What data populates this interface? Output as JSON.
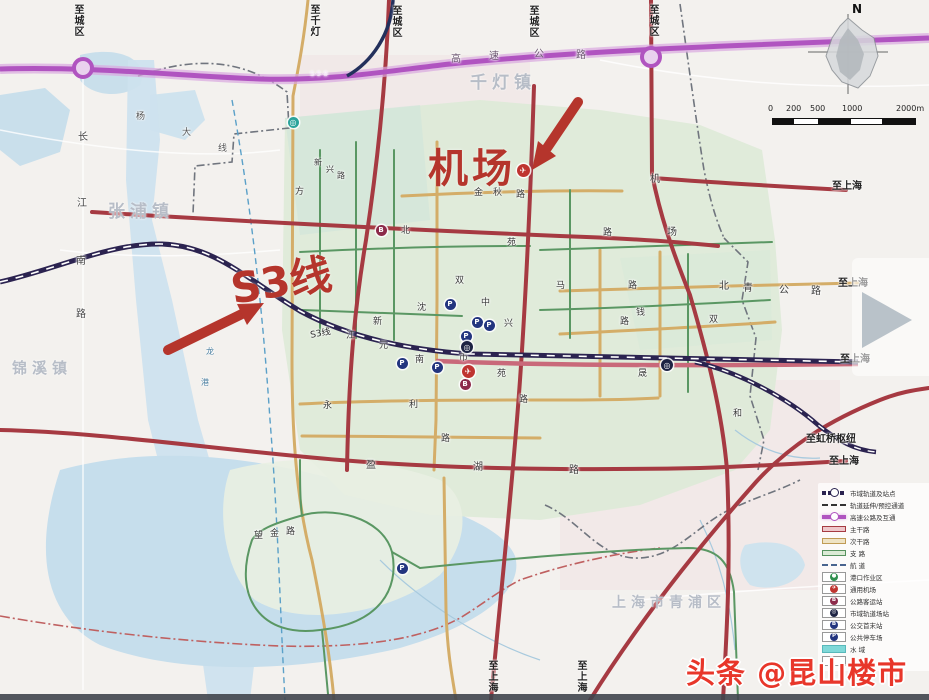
{
  "annotations": {
    "airport": {
      "text": "机场"
    },
    "s3_line": {
      "text": "S3线"
    }
  },
  "watermark": {
    "text": "头条 @昆山楼市信息",
    "color": "#e8362a"
  },
  "compass": {
    "north": "N"
  },
  "scalebar": {
    "ticks": [
      {
        "text": "0",
        "x": 0
      },
      {
        "text": "200",
        "x": 18
      },
      {
        "text": "500",
        "x": 42
      },
      {
        "text": "1000",
        "x": 74
      },
      {
        "text": "2000m",
        "x": 128
      }
    ]
  },
  "towns": [
    {
      "text": "千灯镇",
      "x": 470,
      "y": 68,
      "size": 17
    },
    {
      "text": "张浦镇",
      "x": 108,
      "y": 197,
      "size": 17
    },
    {
      "text": "锦溪镇",
      "x": 12,
      "y": 357,
      "size": 15
    },
    {
      "text": "上海市青浦区",
      "x": 612,
      "y": 592,
      "size": 14
    }
  ],
  "edge_labels": [
    {
      "text": "至城区",
      "x": 70,
      "y": 4,
      "v": true
    },
    {
      "text": "至千灯",
      "x": 306,
      "y": 4,
      "v": true
    },
    {
      "text": "至城区",
      "x": 388,
      "y": 5,
      "v": true
    },
    {
      "text": "至城区",
      "x": 525,
      "y": 5,
      "v": true
    },
    {
      "text": "至城区",
      "x": 645,
      "y": 4,
      "v": true
    },
    {
      "text": "至上海",
      "x": 832,
      "y": 177,
      "v": false
    },
    {
      "text": "至上海",
      "x": 838,
      "y": 274,
      "v": false
    },
    {
      "text": "至上海",
      "x": 840,
      "y": 350,
      "v": false
    },
    {
      "text": "至虹桥枢纽",
      "x": 806,
      "y": 430,
      "v": false
    },
    {
      "text": "至上海",
      "x": 829,
      "y": 452,
      "v": false
    },
    {
      "text": "至上海",
      "x": 484,
      "y": 660,
      "v": true
    },
    {
      "text": "至上海",
      "x": 573,
      "y": 660,
      "v": true
    }
  ],
  "road_labels": [
    {
      "text": "S·5·8",
      "x": 310,
      "y": 70,
      "size": 7,
      "color": "#f6eaf8"
    },
    {
      "text": "高",
      "x": 451,
      "y": 50,
      "size": 10,
      "color": "#6b5570"
    },
    {
      "text": "速",
      "x": 489,
      "y": 47,
      "size": 10,
      "color": "#6b5570"
    },
    {
      "text": "公",
      "x": 534,
      "y": 45,
      "size": 10,
      "color": "#6b5570"
    },
    {
      "text": "路",
      "x": 576,
      "y": 46,
      "size": 10,
      "color": "#6b5570"
    },
    {
      "text": "杨",
      "x": 136,
      "y": 109,
      "size": 9,
      "color": "#555"
    },
    {
      "text": "大",
      "x": 182,
      "y": 125,
      "size": 9,
      "color": "#555"
    },
    {
      "text": "线",
      "x": 218,
      "y": 141,
      "size": 9,
      "color": "#555"
    },
    {
      "text": "长",
      "x": 78,
      "y": 128,
      "size": 10,
      "color": "#444"
    },
    {
      "text": "江",
      "x": 77,
      "y": 194,
      "size": 10,
      "color": "#444"
    },
    {
      "text": "南",
      "x": 76,
      "y": 252,
      "size": 10,
      "color": "#444"
    },
    {
      "text": "路",
      "x": 76,
      "y": 305,
      "size": 10,
      "color": "#444"
    },
    {
      "text": "新",
      "x": 314,
      "y": 157,
      "size": 8,
      "color": "#3a3a3a"
    },
    {
      "text": "兴",
      "x": 326,
      "y": 164,
      "size": 8,
      "color": "#3a3a3a"
    },
    {
      "text": "路",
      "x": 337,
      "y": 170,
      "size": 8,
      "color": "#3a3a3a"
    },
    {
      "text": "方",
      "x": 295,
      "y": 184,
      "size": 9,
      "color": "#3a3a3a"
    },
    {
      "text": "金",
      "x": 474,
      "y": 185,
      "size": 9,
      "color": "#3a3a3a"
    },
    {
      "text": "秋",
      "x": 493,
      "y": 185,
      "size": 9,
      "color": "#3a3a3a"
    },
    {
      "text": "路",
      "x": 516,
      "y": 187,
      "size": 9,
      "color": "#3a3a3a"
    },
    {
      "text": "机",
      "x": 650,
      "y": 170,
      "size": 10,
      "color": "#3a3a3a"
    },
    {
      "text": "场",
      "x": 667,
      "y": 223,
      "size": 10,
      "color": "#3a3a3a"
    },
    {
      "text": "北",
      "x": 401,
      "y": 223,
      "size": 9,
      "color": "#3a3a3a"
    },
    {
      "text": "苑",
      "x": 507,
      "y": 235,
      "size": 9,
      "color": "#3a3a3a"
    },
    {
      "text": "马",
      "x": 556,
      "y": 278,
      "size": 9,
      "color": "#3a3a3a"
    },
    {
      "text": "路",
      "x": 628,
      "y": 278,
      "size": 9,
      "color": "#3a3a3a"
    },
    {
      "text": "钱",
      "x": 636,
      "y": 305,
      "size": 9,
      "color": "#3a3a3a"
    },
    {
      "text": "路",
      "x": 620,
      "y": 314,
      "size": 9,
      "color": "#3a3a3a"
    },
    {
      "text": "双",
      "x": 455,
      "y": 273,
      "size": 9,
      "color": "#3a3a3a"
    },
    {
      "text": "中",
      "x": 481,
      "y": 295,
      "size": 9,
      "color": "#3a3a3a"
    },
    {
      "text": "兴",
      "x": 504,
      "y": 316,
      "size": 9,
      "color": "#3a3a3a"
    },
    {
      "text": "沈",
      "x": 417,
      "y": 300,
      "size": 9,
      "color": "#3a3a3a"
    },
    {
      "text": "新",
      "x": 373,
      "y": 314,
      "size": 9,
      "color": "#3a3a3a"
    },
    {
      "text": "元",
      "x": 379,
      "y": 338,
      "size": 9,
      "color": "#3a3a3a"
    },
    {
      "text": "南",
      "x": 415,
      "y": 352,
      "size": 9,
      "color": "#3a3a3a"
    },
    {
      "text": "江",
      "x": 346,
      "y": 328,
      "size": 9,
      "color": "#3a3a3a"
    },
    {
      "text": "S3线",
      "x": 310,
      "y": 326,
      "size": 9,
      "color": "#2c2c2c",
      "rot": -11
    },
    {
      "text": "市",
      "x": 459,
      "y": 350,
      "size": 9,
      "color": "#3a3a3a"
    },
    {
      "text": "苑",
      "x": 497,
      "y": 366,
      "size": 9,
      "color": "#3a3a3a"
    },
    {
      "text": "路",
      "x": 519,
      "y": 392,
      "size": 9,
      "color": "#3a3a3a"
    },
    {
      "text": "永",
      "x": 323,
      "y": 398,
      "size": 9,
      "color": "#3a3a3a"
    },
    {
      "text": "利",
      "x": 409,
      "y": 397,
      "size": 9,
      "color": "#3a3a3a"
    },
    {
      "text": "路",
      "x": 441,
      "y": 431,
      "size": 9,
      "color": "#3a3a3a"
    },
    {
      "text": "晟",
      "x": 638,
      "y": 366,
      "size": 9,
      "color": "#3a3a3a"
    },
    {
      "text": "北",
      "x": 719,
      "y": 277,
      "size": 10,
      "color": "#3a3a3a"
    },
    {
      "text": "青",
      "x": 743,
      "y": 279,
      "size": 10,
      "color": "#3a3a3a"
    },
    {
      "text": "公",
      "x": 779,
      "y": 281,
      "size": 10,
      "color": "#3a3a3a"
    },
    {
      "text": "路",
      "x": 811,
      "y": 282,
      "size": 10,
      "color": "#3a3a3a"
    },
    {
      "text": "双",
      "x": 709,
      "y": 312,
      "size": 9,
      "color": "#3a3a3a"
    },
    {
      "text": "和",
      "x": 733,
      "y": 406,
      "size": 9,
      "color": "#3a3a3a"
    },
    {
      "text": "盈",
      "x": 366,
      "y": 456,
      "size": 10,
      "color": "#3a3a3a"
    },
    {
      "text": "湖",
      "x": 473,
      "y": 458,
      "size": 10,
      "color": "#3a3a3a"
    },
    {
      "text": "路",
      "x": 569,
      "y": 461,
      "size": 10,
      "color": "#3a3a3a"
    },
    {
      "text": "望",
      "x": 254,
      "y": 528,
      "size": 9,
      "color": "#3a3a3a"
    },
    {
      "text": "金",
      "x": 270,
      "y": 526,
      "size": 9,
      "color": "#3a3a3a"
    },
    {
      "text": "路",
      "x": 286,
      "y": 524,
      "size": 9,
      "color": "#3a3a3a"
    },
    {
      "text": "路",
      "x": 603,
      "y": 225,
      "size": 9,
      "color": "#3a3a3a"
    },
    {
      "text": "龙",
      "x": 206,
      "y": 346,
      "size": 8,
      "color": "#4a7fa0"
    },
    {
      "text": "港",
      "x": 201,
      "y": 377,
      "size": 8,
      "color": "#4a7fa0"
    }
  ],
  "markers": [
    {
      "type": "p",
      "glyph": "P",
      "x": 450,
      "y": 304
    },
    {
      "type": "p",
      "glyph": "P",
      "x": 477,
      "y": 322
    },
    {
      "type": "p",
      "glyph": "P",
      "x": 489,
      "y": 325
    },
    {
      "type": "p",
      "glyph": "P",
      "x": 466,
      "y": 336
    },
    {
      "type": "p",
      "glyph": "P",
      "x": 437,
      "y": 367
    },
    {
      "type": "p",
      "glyph": "P",
      "x": 402,
      "y": 363
    },
    {
      "type": "p",
      "glyph": "P",
      "x": 402,
      "y": 568
    },
    {
      "type": "b",
      "glyph": "B",
      "x": 381,
      "y": 230
    },
    {
      "type": "b",
      "glyph": "B",
      "x": 465,
      "y": 384
    },
    {
      "type": "plane",
      "glyph": "✈",
      "x": 523,
      "y": 170
    },
    {
      "type": "plane",
      "glyph": "✈",
      "x": 468,
      "y": 371
    },
    {
      "type": "station",
      "glyph": "◎",
      "x": 467,
      "y": 347
    },
    {
      "type": "station",
      "glyph": "◎",
      "x": 667,
      "y": 365
    },
    {
      "type": "teal",
      "glyph": "◎",
      "x": 293,
      "y": 122
    }
  ],
  "legend": {
    "items": [
      {
        "label": "市域轨道及站点",
        "swatch": "rail"
      },
      {
        "label": "轨道延伸/预控通道",
        "swatch": "dash"
      },
      {
        "label": "高速公路及互通",
        "swatch": "hwy"
      },
      {
        "label": "主干路",
        "swatch": "red"
      },
      {
        "label": "次干路",
        "swatch": "tan"
      },
      {
        "label": "支  路",
        "swatch": "green"
      },
      {
        "label": "航  道",
        "swatch": "canal"
      },
      {
        "label": "港口作业区",
        "swatch": "box",
        "glyph": "●",
        "dot": "#2f8f4e"
      },
      {
        "label": "通用机场",
        "swatch": "box",
        "glyph": "✈",
        "dot": "#bf3430"
      },
      {
        "label": "公路客运站",
        "swatch": "box",
        "glyph": "B",
        "dot": "#8c2b4a"
      },
      {
        "label": "市域轨道场站",
        "swatch": "box",
        "glyph": "◎",
        "dot": "#1d2343"
      },
      {
        "label": "公交首末站",
        "swatch": "box",
        "glyph": "B",
        "dot": "#23357f"
      },
      {
        "label": "公共停车场",
        "swatch": "box",
        "glyph": "P",
        "dot": "#23357f"
      },
      {
        "label": "水  域",
        "swatch": "water"
      },
      {
        "label": "镇  界",
        "swatch": "box"
      }
    ]
  },
  "colors": {
    "highway": "#b054c0",
    "major_road": "#a63a42",
    "secondary_road": "#d4ad68",
    "minor_road": "#5a9763",
    "rail": "#2b2350",
    "water": "#c9dfeb",
    "annotation_red": "#b5352c"
  }
}
